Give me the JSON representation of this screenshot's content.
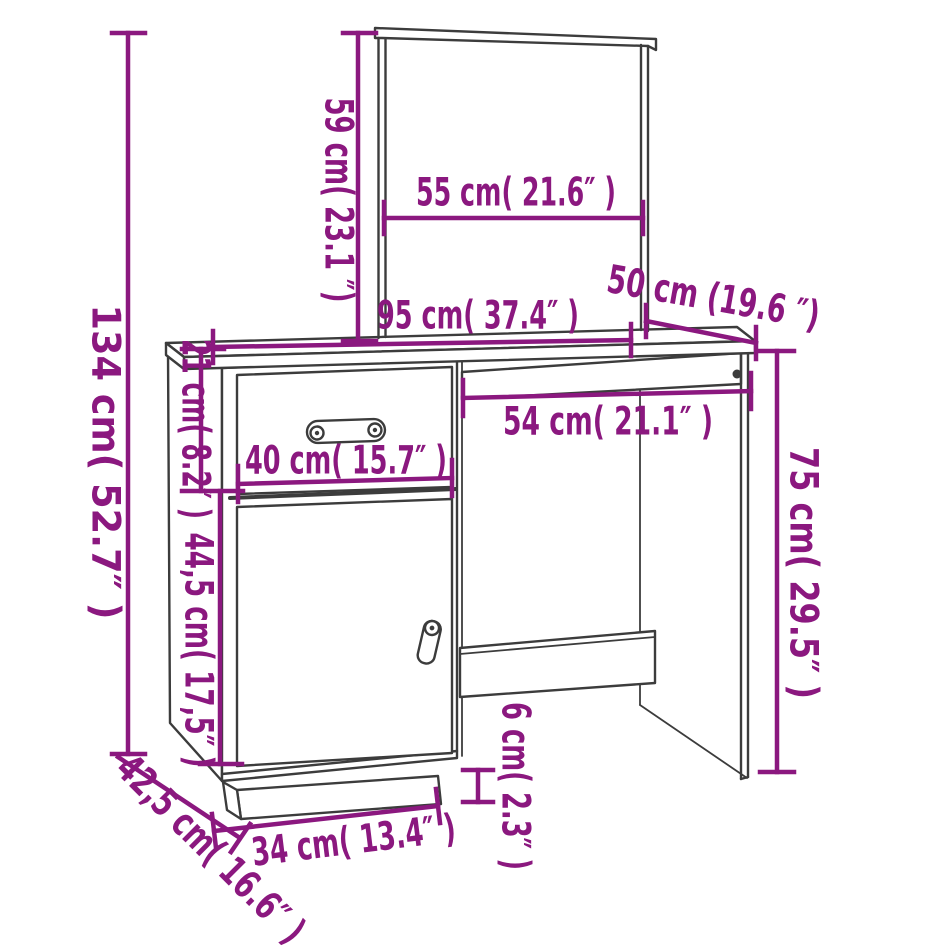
{
  "diagram": {
    "type": "furniture-dimension-diagram",
    "subject": "dressing table with mirror, drawer, door and keyboard tray",
    "colors": {
      "accent": "#8B187F",
      "line": "#3C3C3C"
    }
  },
  "dims": {
    "mirror_height": "59 cm( 23.1 ″)",
    "mirror_width": "55 cm( 21.6″ )",
    "desk_depth": "50 cm (19.6 ″)",
    "desk_width": "95 cm( 37.4″ )",
    "total_height": "134 cm( 52.7″ )",
    "drawer_height": "21 cm( 8.2″ )",
    "cabinet_width": "40 cm( 15.7″ )",
    "door_height": "44,5 cm( 17,5″ )",
    "knee_width": "54 cm( 21.1″ )",
    "desk_height": "75 cm( 29.5″ )",
    "plinth_height": "6 cm( 2.3″ )",
    "base_width": "34 cm( 13.4″ )",
    "base_depth": "42,5 cm( 16.6″ )"
  }
}
